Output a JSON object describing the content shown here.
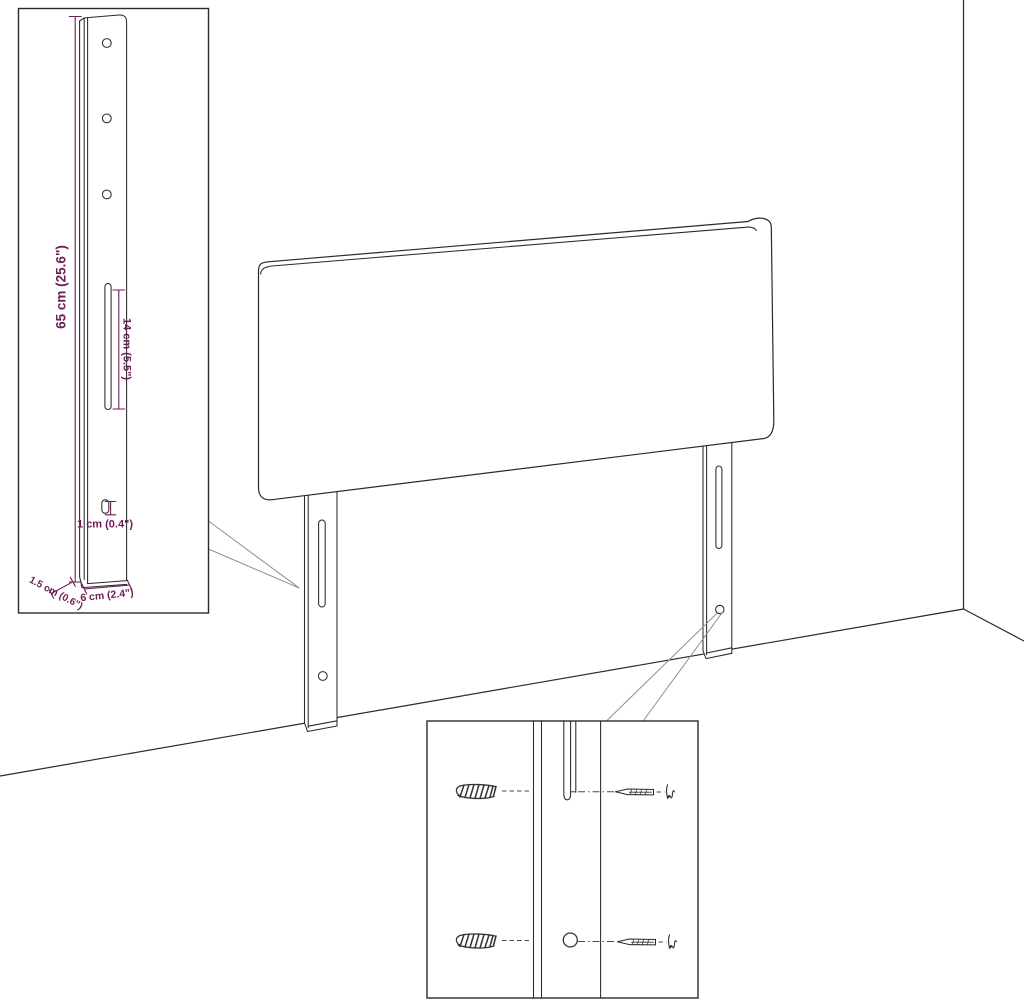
{
  "colors": {
    "line": "#2a2a2a",
    "dimension_text": "#6e1c56",
    "callout_line": "#8f8f8f",
    "background": "#ffffff"
  },
  "bracket_inset": {
    "dimension_labels": {
      "height": "65 cm (25.6\")",
      "slot_length": "14 cm (5.5\")",
      "hook": "1 cm (0.4\")",
      "thickness": "1.5 cm (0.6\")",
      "width": "6 cm (2.4\")"
    }
  },
  "screw_inset": {}
}
